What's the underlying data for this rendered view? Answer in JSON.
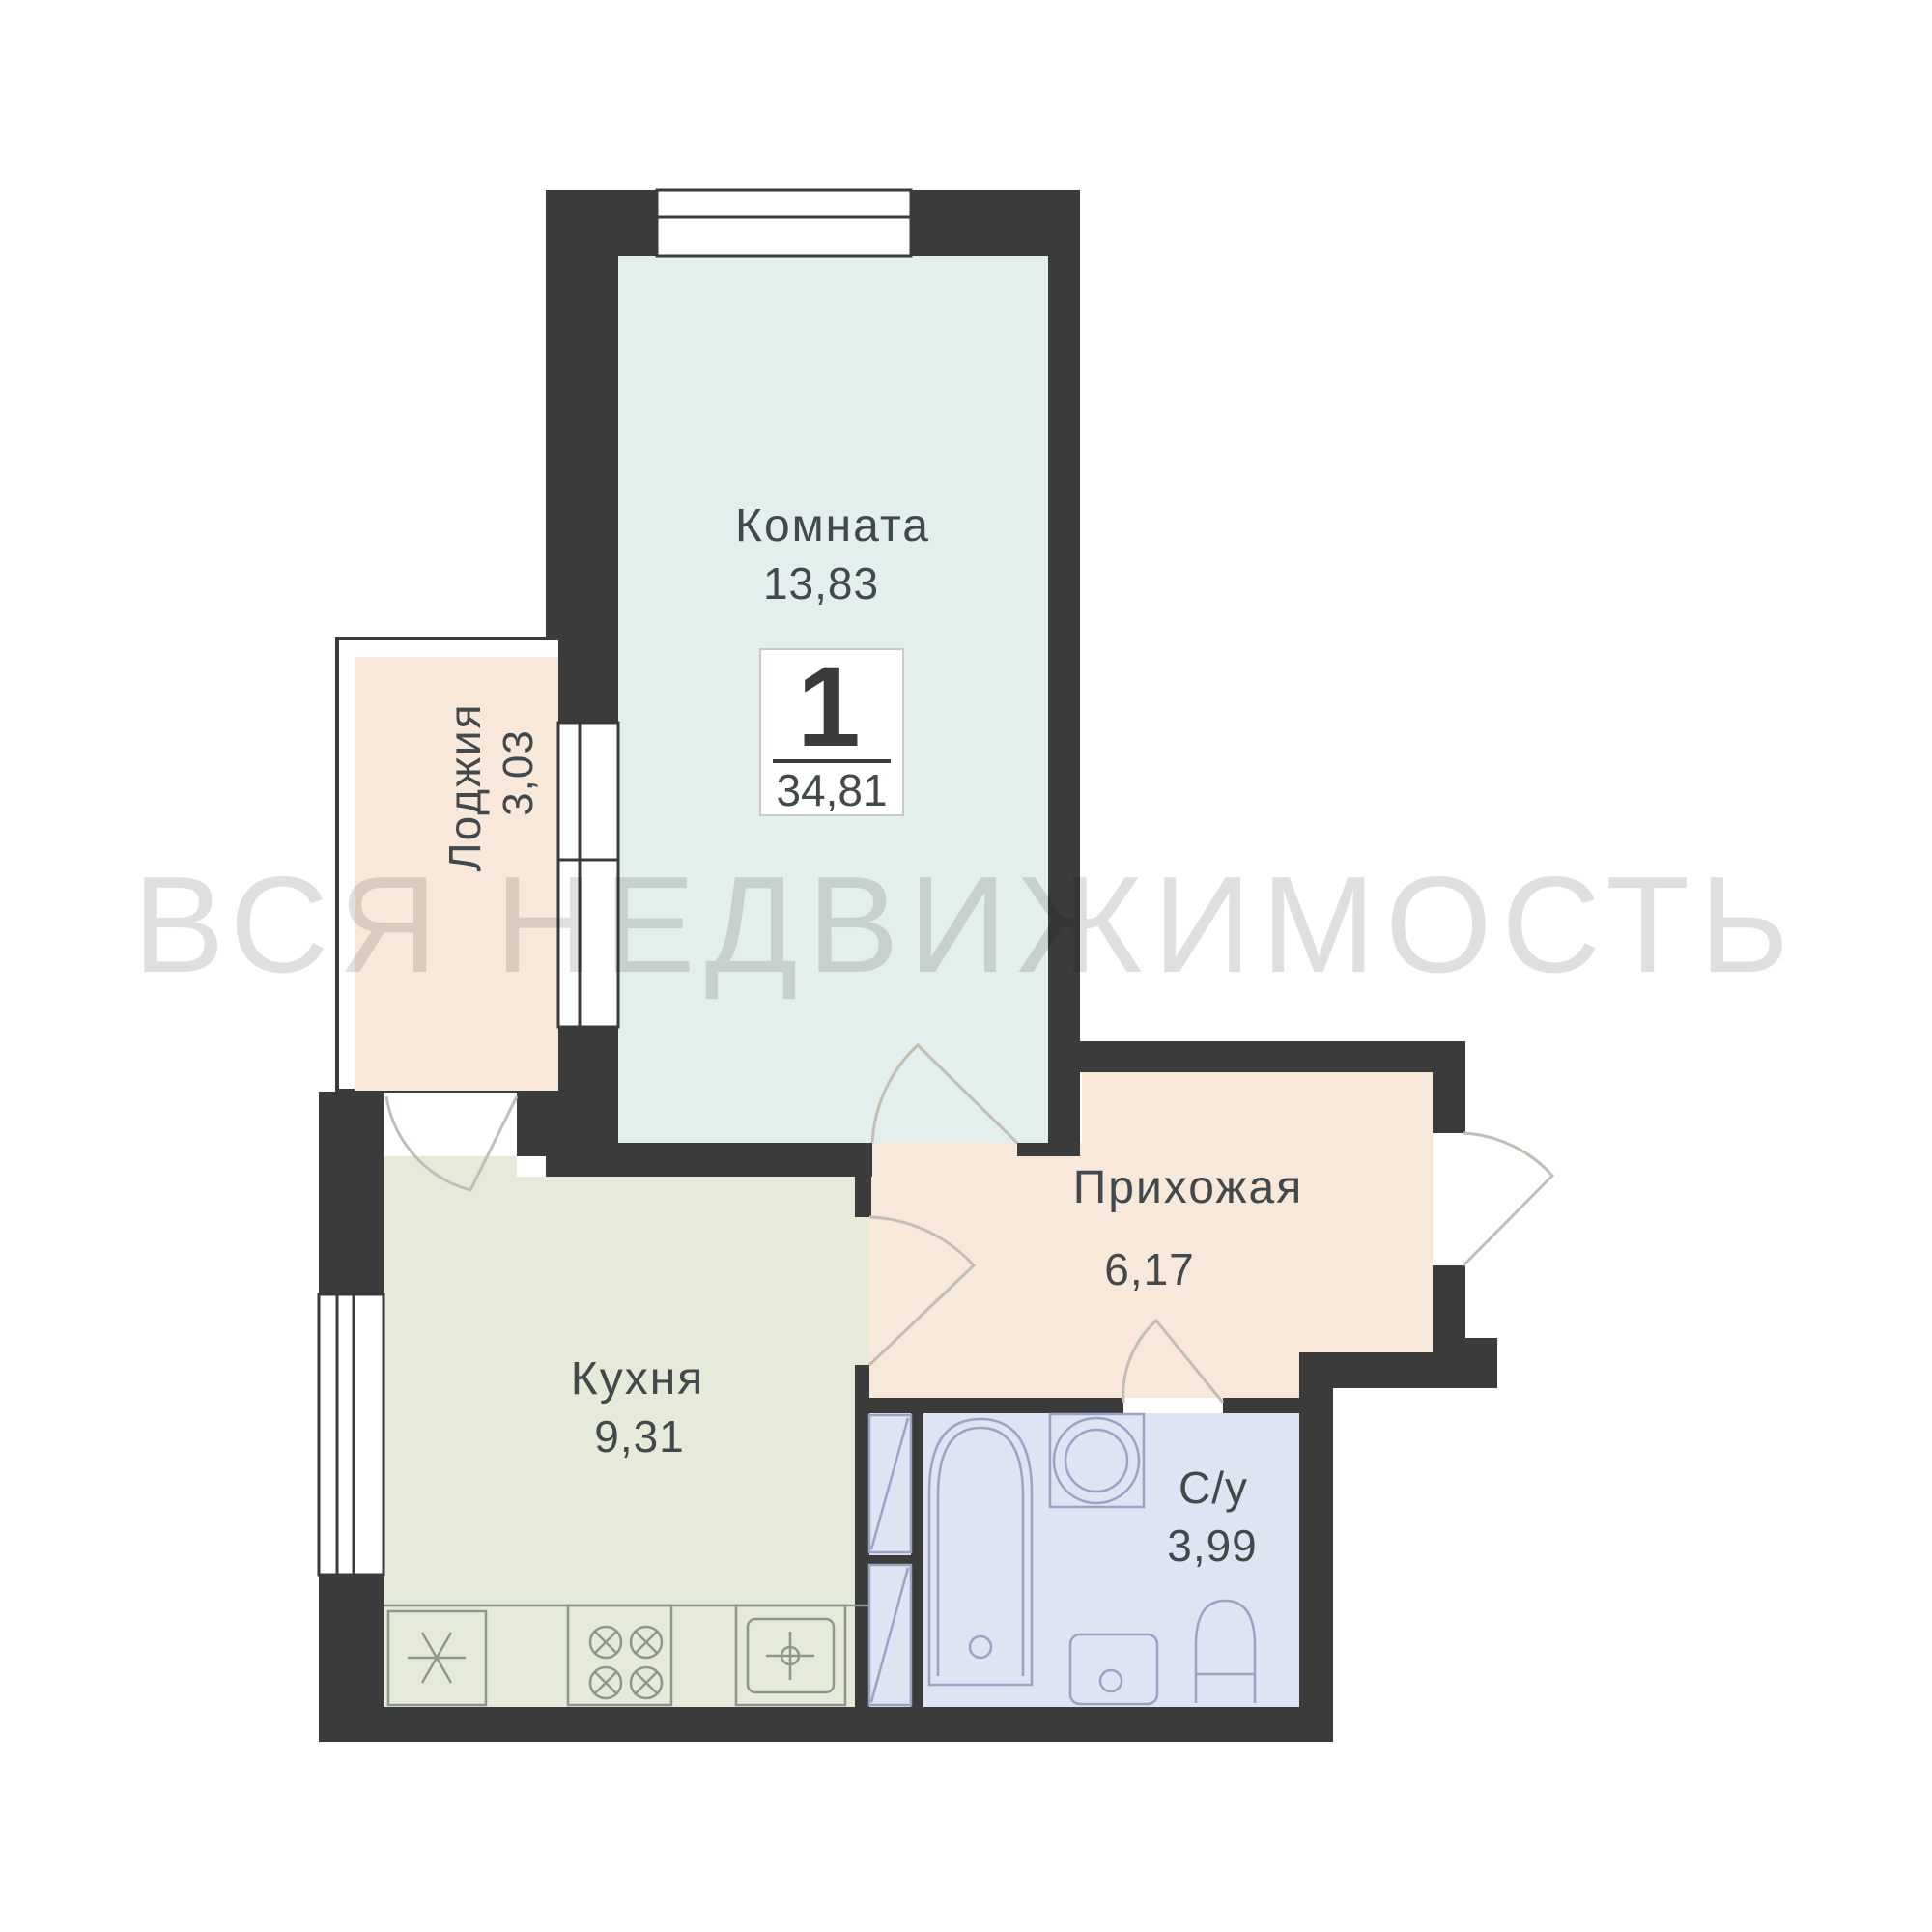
{
  "watermark": "ВСЯ НЕДВИЖИМОСТЬ",
  "apartment_badge": {
    "room_count": "1",
    "total_area": "34,81"
  },
  "rooms": {
    "living_room": {
      "name": "Комната",
      "area": "13,83"
    },
    "loggia": {
      "name": "Лоджия",
      "area": "3,03"
    },
    "kitchen": {
      "name": "Кухня",
      "area": "9,31"
    },
    "hallway": {
      "name": "Прихожая",
      "area": "6,17"
    },
    "bathroom": {
      "name": "С/у",
      "area": "3,99"
    }
  },
  "colors": {
    "wall": "#3b3b3b",
    "living_room_fill": "#e3efec",
    "kitchen_fill": "#e6ead9",
    "hallway_fill": "#f8e8da",
    "loggia_fill": "#f8e8da",
    "bathroom_fill": "#dfe4f3",
    "label_text": "#43484a",
    "watermark_text": "#dfdfdf"
  }
}
